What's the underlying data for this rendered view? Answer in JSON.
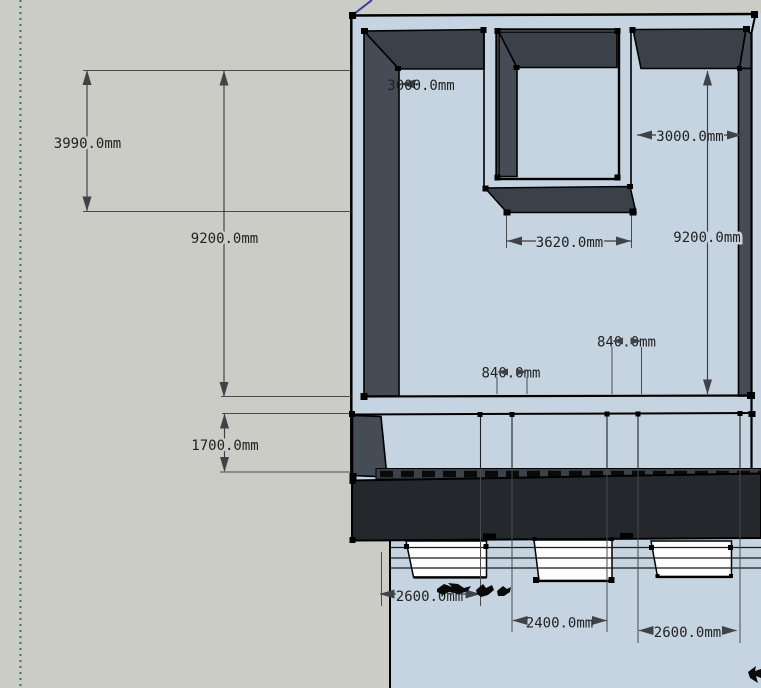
{
  "colors": {
    "bg": "#cbccc6",
    "ground": "#c5d4e0",
    "wall_top": "#3a4149",
    "wall_side": "#454c55",
    "slab": "#24272b",
    "ledge": "#3b424a",
    "window": "#fdfdfd",
    "edge": "#000000",
    "dim_line": "#3f3f3f",
    "dim_text": "#222222",
    "axis_green": "#3e7a47",
    "axis_blue": "#3c3c9e"
  },
  "dimensions": {
    "height_upper_section": "3990.0mm",
    "height_total_left": "9200.0mm",
    "height_lower_floor": "1700.0mm",
    "wall_left_length": "3000.0mm",
    "wall_right_length": "3000.0mm",
    "recess_opening_width": "3620.0mm",
    "interior_depth": "9200.0mm",
    "pier_width_left": "840.0mm",
    "pier_width_right": "840.0mm",
    "window_left_width": "2600.0mm",
    "window_middle_width": "2400.0mm",
    "window_right_width": "2600.0mm"
  }
}
